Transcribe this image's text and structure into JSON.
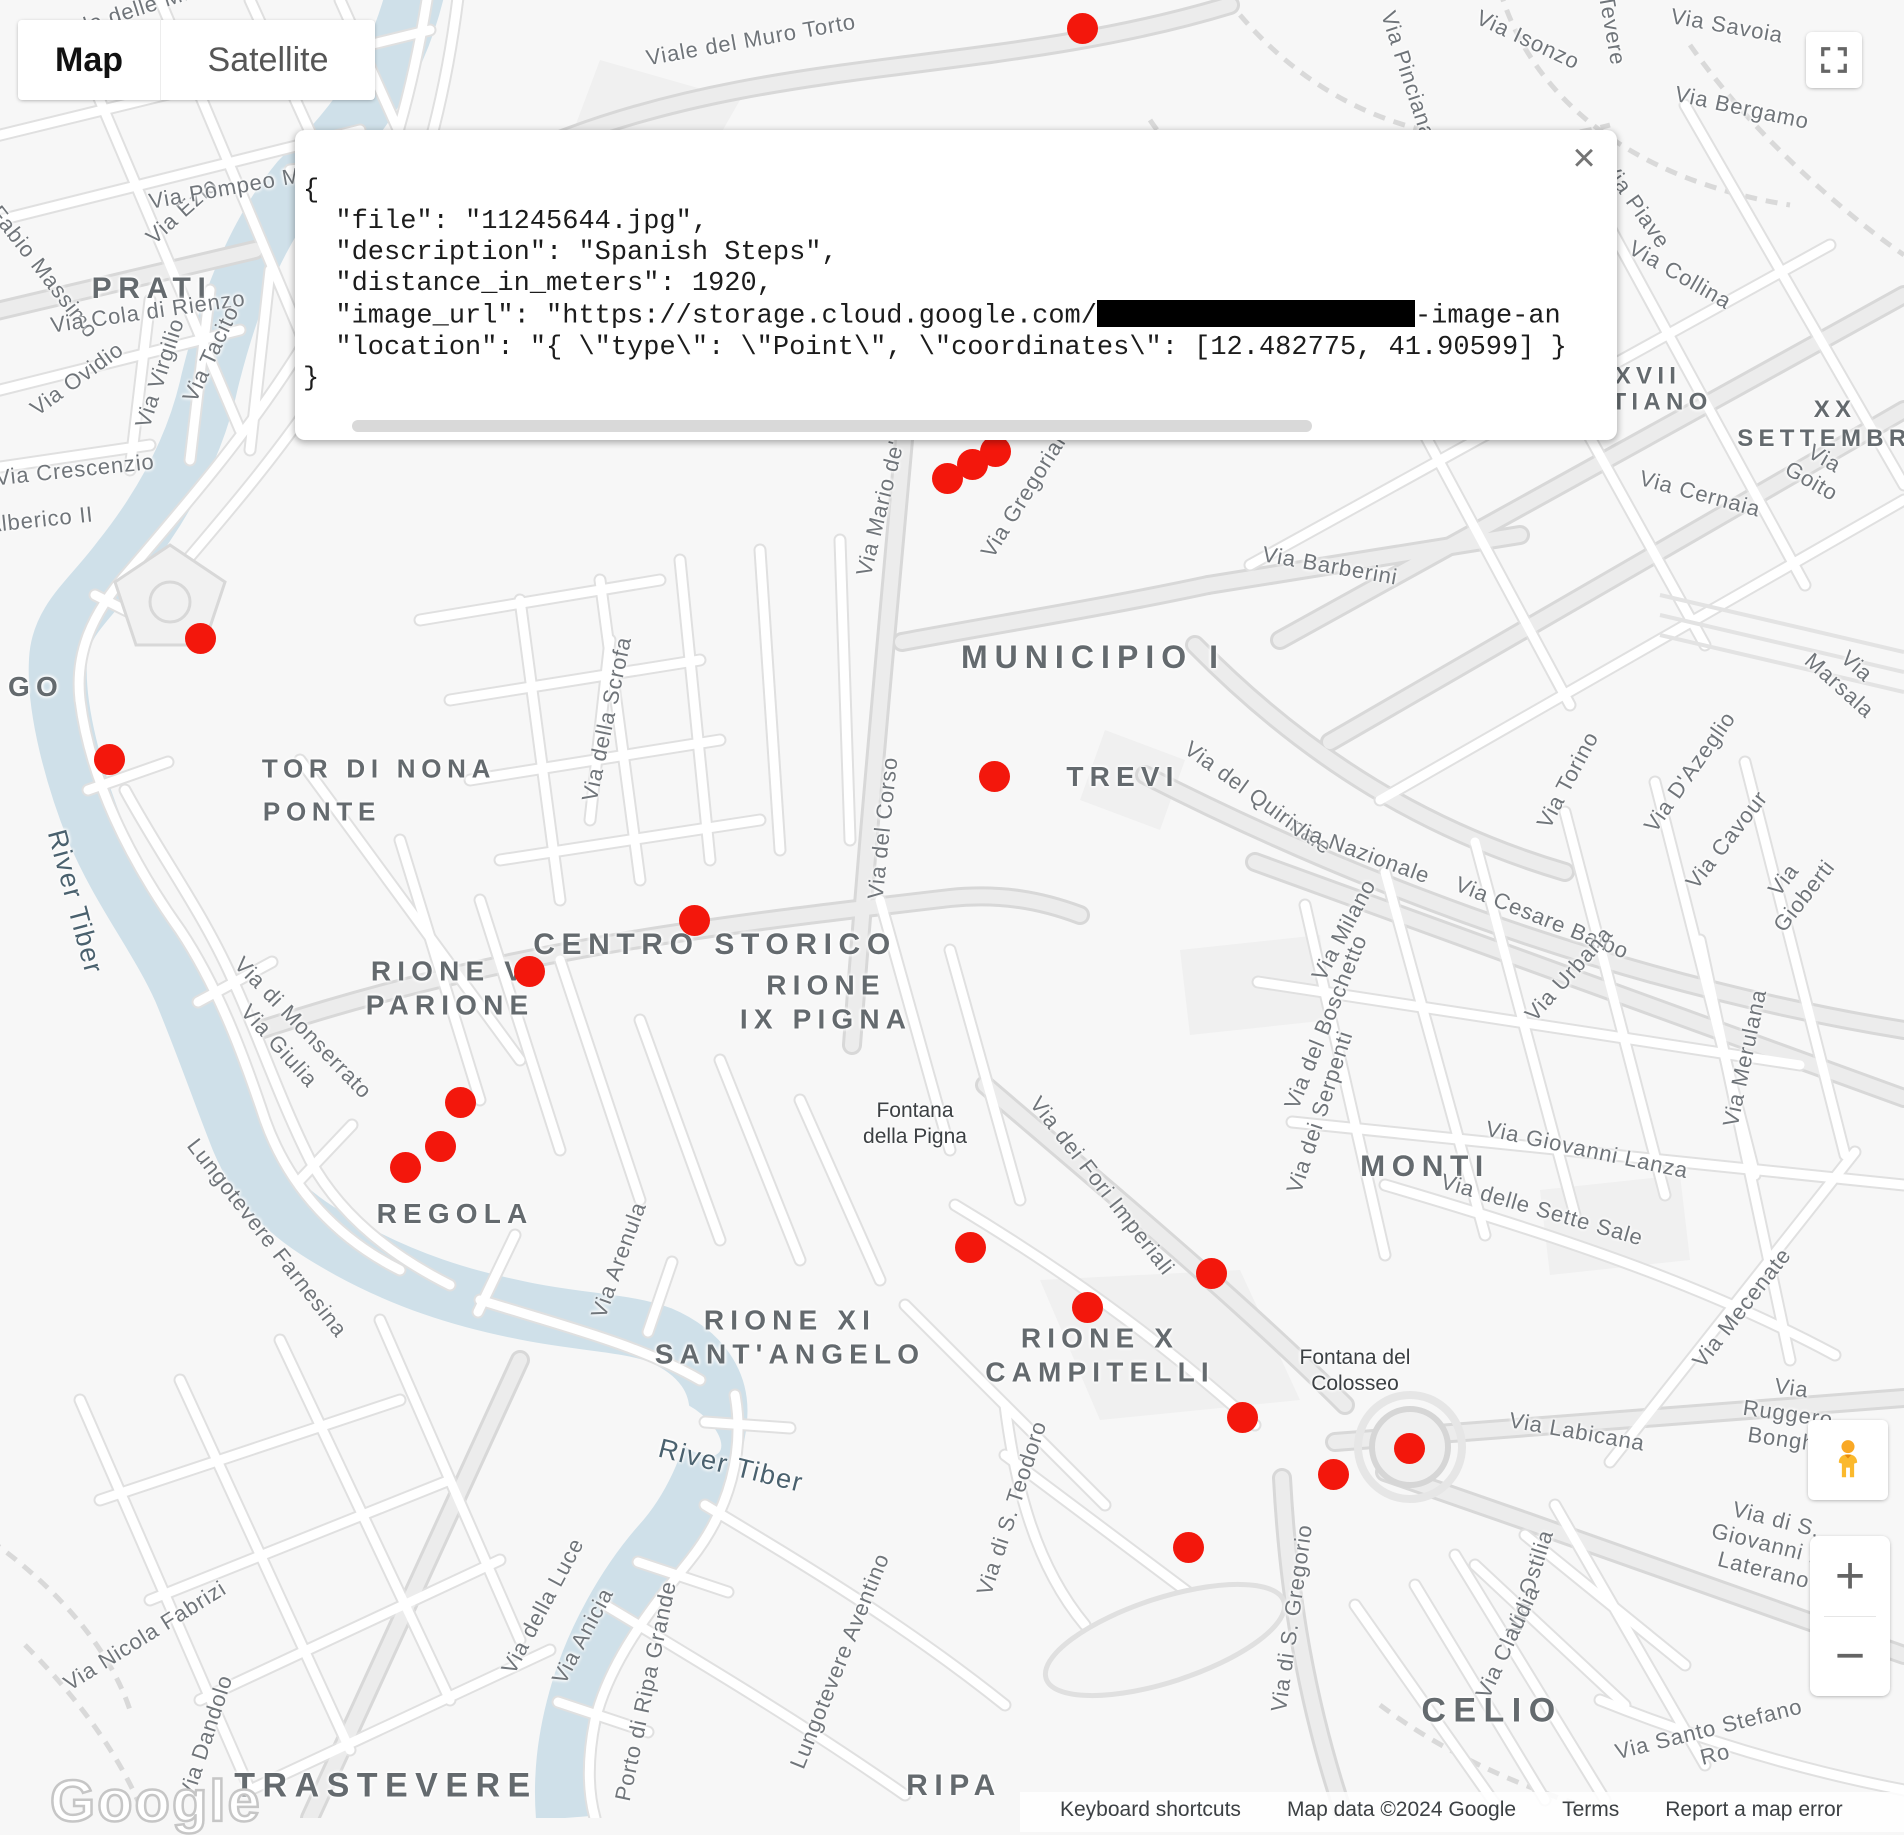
{
  "map_controls": {
    "map_label": "Map",
    "satellite_label": "Satellite",
    "zoom_in_label": "+",
    "zoom_out_label": "−",
    "close_label": "×"
  },
  "info_window": {
    "lines": [
      {
        "text": "{"
      },
      {
        "text": "  \"file\": \"11245644.jpg\","
      },
      {
        "text": "  \"description\": \"Spanish Steps\","
      },
      {
        "text": "  \"distance_in_meters\": 1920,"
      },
      {
        "pre": "  \"image_url\": \"https://storage.cloud.google.com/",
        "redacted_width": 318,
        "post": "-image-an"
      },
      {
        "text": "  \"location\": \"{ \\\"type\\\": \\\"Point\\\", \\\"coordinates\\\": [12.482775, 41.90599] }"
      },
      {
        "text": "}"
      }
    ]
  },
  "google_logo": "Google",
  "attribution": {
    "items": [
      "Keyboard shortcuts",
      "Map data ©2024 Google",
      "Terms",
      "Report a map error"
    ]
  },
  "map": {
    "colors": {
      "marker_red": "#F3170C",
      "water": "#cfe0e9",
      "background": "#f7f7f7",
      "road_casing": "#e0e0e0"
    },
    "markers": [
      {
        "x": 1082,
        "y": 28
      },
      {
        "x": 995,
        "y": 451
      },
      {
        "x": 972,
        "y": 464
      },
      {
        "x": 947,
        "y": 478
      },
      {
        "x": 200,
        "y": 638
      },
      {
        "x": 109,
        "y": 759
      },
      {
        "x": 994,
        "y": 776
      },
      {
        "x": 694,
        "y": 920
      },
      {
        "x": 529,
        "y": 971
      },
      {
        "x": 460,
        "y": 1102
      },
      {
        "x": 440,
        "y": 1146
      },
      {
        "x": 405,
        "y": 1167
      },
      {
        "x": 970,
        "y": 1247
      },
      {
        "x": 1211,
        "y": 1273
      },
      {
        "x": 1087,
        "y": 1307
      },
      {
        "x": 1242,
        "y": 1417
      },
      {
        "x": 1409,
        "y": 1448
      },
      {
        "x": 1333,
        "y": 1474
      },
      {
        "x": 1188,
        "y": 1547
      }
    ],
    "district_labels": [
      {
        "text": "PRATI",
        "x": 152,
        "y": 289,
        "size": 30
      },
      {
        "text": "GO",
        "x": 8,
        "y": 687,
        "size": 28,
        "anchor": "left"
      },
      {
        "text": "TOR DI NONA",
        "x": 379,
        "y": 769,
        "size": 26
      },
      {
        "text": "PONTE",
        "x": 322,
        "y": 812,
        "size": 26
      },
      {
        "text": "MUNICIPIO I",
        "x": 1093,
        "y": 657,
        "size": 32
      },
      {
        "text": "TREVI",
        "x": 1123,
        "y": 777,
        "size": 28
      },
      {
        "text": "CENTRO STORICO",
        "x": 715,
        "y": 945,
        "size": 30
      },
      {
        "text": "RIONE V\nPARIONE",
        "x": 450,
        "y": 988,
        "size": 28
      },
      {
        "text": "RIONE\nIX PIGNA",
        "x": 826,
        "y": 1002,
        "size": 28
      },
      {
        "text": "REGOLA",
        "x": 455,
        "y": 1214,
        "size": 28
      },
      {
        "text": "MONTI",
        "x": 1425,
        "y": 1167,
        "size": 30
      },
      {
        "text": "RIONE XI\nSANT'ANGELO",
        "x": 790,
        "y": 1337,
        "size": 28
      },
      {
        "text": "RIONE X\nCAMPITELLI",
        "x": 1100,
        "y": 1355,
        "size": 28
      },
      {
        "text": "CELIO",
        "x": 1492,
        "y": 1711,
        "size": 34
      },
      {
        "text": "TRASTEVERE",
        "x": 386,
        "y": 1786,
        "size": 34
      },
      {
        "text": "RIPA",
        "x": 954,
        "y": 1786,
        "size": 30
      },
      {
        "text": "XVII",
        "x": 1648,
        "y": 377,
        "size": 24
      },
      {
        "text": "TIANO",
        "x": 1662,
        "y": 403,
        "size": 24
      },
      {
        "text": "XX SETTEMBRE",
        "x": 1835,
        "y": 425,
        "size": 24
      }
    ],
    "street_labels": [
      {
        "text": "Viale delle Milizie",
        "x": 140,
        "y": 8,
        "rot": -18
      },
      {
        "text": "Viale del Muro Torto",
        "x": 751,
        "y": 40,
        "rot": -10
      },
      {
        "text": "Via Pinciana",
        "x": 1408,
        "y": 75,
        "rot": 72
      },
      {
        "text": "Via Isonzo",
        "x": 1528,
        "y": 40,
        "rot": 25
      },
      {
        "text": "Tevere",
        "x": 1612,
        "y": 30,
        "rot": 80
      },
      {
        "text": "Via Savoia",
        "x": 1727,
        "y": 26,
        "rot": 10
      },
      {
        "text": "Via Bergamo",
        "x": 1742,
        "y": 108,
        "rot": 12
      },
      {
        "text": "Via Piave",
        "x": 1636,
        "y": 205,
        "rot": 55
      },
      {
        "text": "Via Collina",
        "x": 1680,
        "y": 275,
        "rot": 30
      },
      {
        "text": "Via Goito",
        "x": 1818,
        "y": 470,
        "rot": 30
      },
      {
        "text": "Via Cernaia",
        "x": 1700,
        "y": 494,
        "rot": 15
      },
      {
        "text": "Via Marsala",
        "x": 1848,
        "y": 676,
        "rot": 42
      },
      {
        "text": "Via Ezio",
        "x": 182,
        "y": 211,
        "rot": -42
      },
      {
        "text": "Via Pompeo Magno",
        "x": 251,
        "y": 184,
        "rot": -10
      },
      {
        "text": "Fabio Massimo",
        "x": 44,
        "y": 272,
        "rot": 52
      },
      {
        "text": "Via Cola di Rienzo",
        "x": 148,
        "y": 312,
        "rot": -8
      },
      {
        "text": "Via Ovidio",
        "x": 77,
        "y": 379,
        "rot": -36
      },
      {
        "text": "Via Virgilio",
        "x": 160,
        "y": 373,
        "rot": -72
      },
      {
        "text": "Via Tacito",
        "x": 211,
        "y": 354,
        "rot": -65
      },
      {
        "text": "Via Crescenzio",
        "x": 75,
        "y": 470,
        "rot": -6
      },
      {
        "text": "Via Alberico II",
        "x": 20,
        "y": 522,
        "rot": -6
      },
      {
        "text": "Via Mario de' Fiori",
        "x": 887,
        "y": 482,
        "rot": -76
      },
      {
        "text": "Via Gregoriana",
        "x": 1029,
        "y": 488,
        "rot": -58
      },
      {
        "text": "Via Barberini",
        "x": 1330,
        "y": 566,
        "rot": 10
      },
      {
        "text": "Via della Scrofa",
        "x": 607,
        "y": 719,
        "rot": -78
      },
      {
        "text": "Via del Corso",
        "x": 883,
        "y": 828,
        "rot": -84
      },
      {
        "text": "Via del Quirinale",
        "x": 1258,
        "y": 798,
        "rot": 36
      },
      {
        "text": "Via Nazionale",
        "x": 1360,
        "y": 852,
        "rot": 20
      },
      {
        "text": "Via Torino",
        "x": 1568,
        "y": 780,
        "rot": -62
      },
      {
        "text": "Via D'Azeglio",
        "x": 1690,
        "y": 772,
        "rot": -55
      },
      {
        "text": "Via Cavour",
        "x": 1727,
        "y": 840,
        "rot": -52
      },
      {
        "text": "Via Gioberti",
        "x": 1794,
        "y": 888,
        "rot": -52
      },
      {
        "text": "Via Milano",
        "x": 1344,
        "y": 930,
        "rot": -62
      },
      {
        "text": "Via Cesare Balbo",
        "x": 1542,
        "y": 918,
        "rot": 22
      },
      {
        "text": "Via Urbana",
        "x": 1569,
        "y": 974,
        "rot": -48
      },
      {
        "text": "Via del Boschetto",
        "x": 1326,
        "y": 1022,
        "rot": -68
      },
      {
        "text": "Via dei Serpenti",
        "x": 1320,
        "y": 1112,
        "rot": -72
      },
      {
        "text": "Via Merulana",
        "x": 1745,
        "y": 1058,
        "rot": -78
      },
      {
        "text": "Via Giovanni Lanza",
        "x": 1587,
        "y": 1150,
        "rot": 12
      },
      {
        "text": "Via delle Sette Sale",
        "x": 1542,
        "y": 1210,
        "rot": 16
      },
      {
        "text": "Via Mecenate",
        "x": 1742,
        "y": 1308,
        "rot": -52
      },
      {
        "text": "Via dei Fori Imperiali",
        "x": 1102,
        "y": 1186,
        "rot": 52
      },
      {
        "text": "Via di Monserrato",
        "x": 303,
        "y": 1028,
        "rot": 46
      },
      {
        "text": "Via Giulia",
        "x": 279,
        "y": 1046,
        "rot": 48
      },
      {
        "text": "Lungotevere Farnesina",
        "x": 267,
        "y": 1238,
        "rot": 52
      },
      {
        "text": "Via Arenula",
        "x": 619,
        "y": 1260,
        "rot": -70
      },
      {
        "text": "Via di S. Teodoro",
        "x": 1012,
        "y": 1508,
        "rot": -72
      },
      {
        "text": "Via Labicana",
        "x": 1577,
        "y": 1432,
        "rot": 10
      },
      {
        "text": "Via Ruggero Bonghi",
        "x": 1788,
        "y": 1414,
        "rot": 8
      },
      {
        "text": "Via di S. Giovanni in Laterano",
        "x": 1770,
        "y": 1545,
        "rot": 14
      },
      {
        "text": "Via Ostilia",
        "x": 1530,
        "y": 1582,
        "rot": -72
      },
      {
        "text": "Via Claudia",
        "x": 1508,
        "y": 1642,
        "rot": -65
      },
      {
        "text": "Via Santo Stefano Ro",
        "x": 1712,
        "y": 1742,
        "rot": -14
      },
      {
        "text": "Via di S. Gregorio",
        "x": 1292,
        "y": 1618,
        "rot": -82
      },
      {
        "text": "Via della Luce",
        "x": 543,
        "y": 1606,
        "rot": -62
      },
      {
        "text": "Via Anicia",
        "x": 583,
        "y": 1636,
        "rot": -62
      },
      {
        "text": "Via Nicola Fabrizi",
        "x": 145,
        "y": 1636,
        "rot": -32
      },
      {
        "text": "Via Dandolo",
        "x": 206,
        "y": 1737,
        "rot": -72
      },
      {
        "text": "Porto di Ripa Grande",
        "x": 646,
        "y": 1691,
        "rot": -78
      },
      {
        "text": "Lungotevere Aventino",
        "x": 840,
        "y": 1661,
        "rot": -68
      }
    ],
    "water_labels": [
      {
        "text": "River Tiber",
        "x": 75,
        "y": 902,
        "rot": 75
      },
      {
        "text": "River Tiber",
        "x": 731,
        "y": 1466,
        "rot": 14
      }
    ],
    "poi_labels": [
      {
        "text": "Fontana\ndella Pigna",
        "x": 915,
        "y": 1124
      },
      {
        "text": "Fontana del\nColosseo",
        "x": 1355,
        "y": 1371
      }
    ]
  }
}
